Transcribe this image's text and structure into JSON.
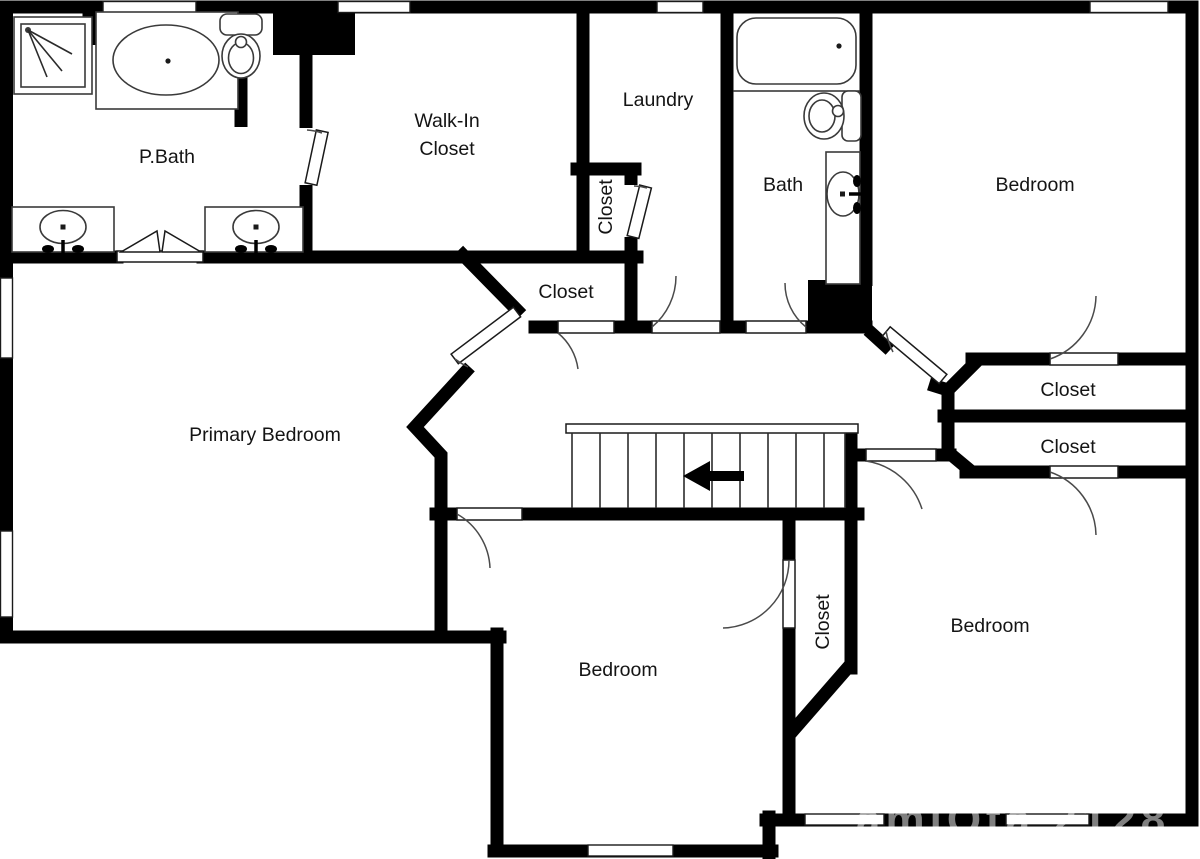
{
  "page": {
    "background": "#ffffff"
  },
  "plan": {
    "type": "residential-floor-plan",
    "wall_color": "#000000",
    "door_arc_color": "#4a4a4a",
    "label_color": "#141414",
    "rooms": [
      {
        "name": "p-bath",
        "label": "P.Bath"
      },
      {
        "name": "walk-in-closet",
        "label_line1": "Walk-In",
        "label_line2": "Closet"
      },
      {
        "name": "laundry",
        "label": "Laundry"
      },
      {
        "name": "laundry-closet",
        "label": "Closet",
        "orientation": "vertical"
      },
      {
        "name": "bath",
        "label": "Bath"
      },
      {
        "name": "bedroom-top-right",
        "label": "Bedroom"
      },
      {
        "name": "hall-closet",
        "label": "Closet"
      },
      {
        "name": "primary-bedroom",
        "label": "Primary Bedroom"
      },
      {
        "name": "closet-right-upper",
        "label": "Closet"
      },
      {
        "name": "closet-right-lower",
        "label": "Closet"
      },
      {
        "name": "bedroom-bottom-middle",
        "label": "Bedroom"
      },
      {
        "name": "closet-bottom-middle",
        "label": "Closet",
        "orientation": "vertical"
      },
      {
        "name": "bedroom-bottom-right",
        "label": "Bedroom"
      }
    ],
    "fixtures": [
      "shower",
      "bathtub-oval",
      "bathtub",
      "toilet",
      "toilet",
      "vanity-sink",
      "vanity-sink",
      "vanity-sink"
    ],
    "stairs": {
      "treads": 11,
      "arrow_direction": "left"
    },
    "watermark": "amlOta 2128"
  }
}
